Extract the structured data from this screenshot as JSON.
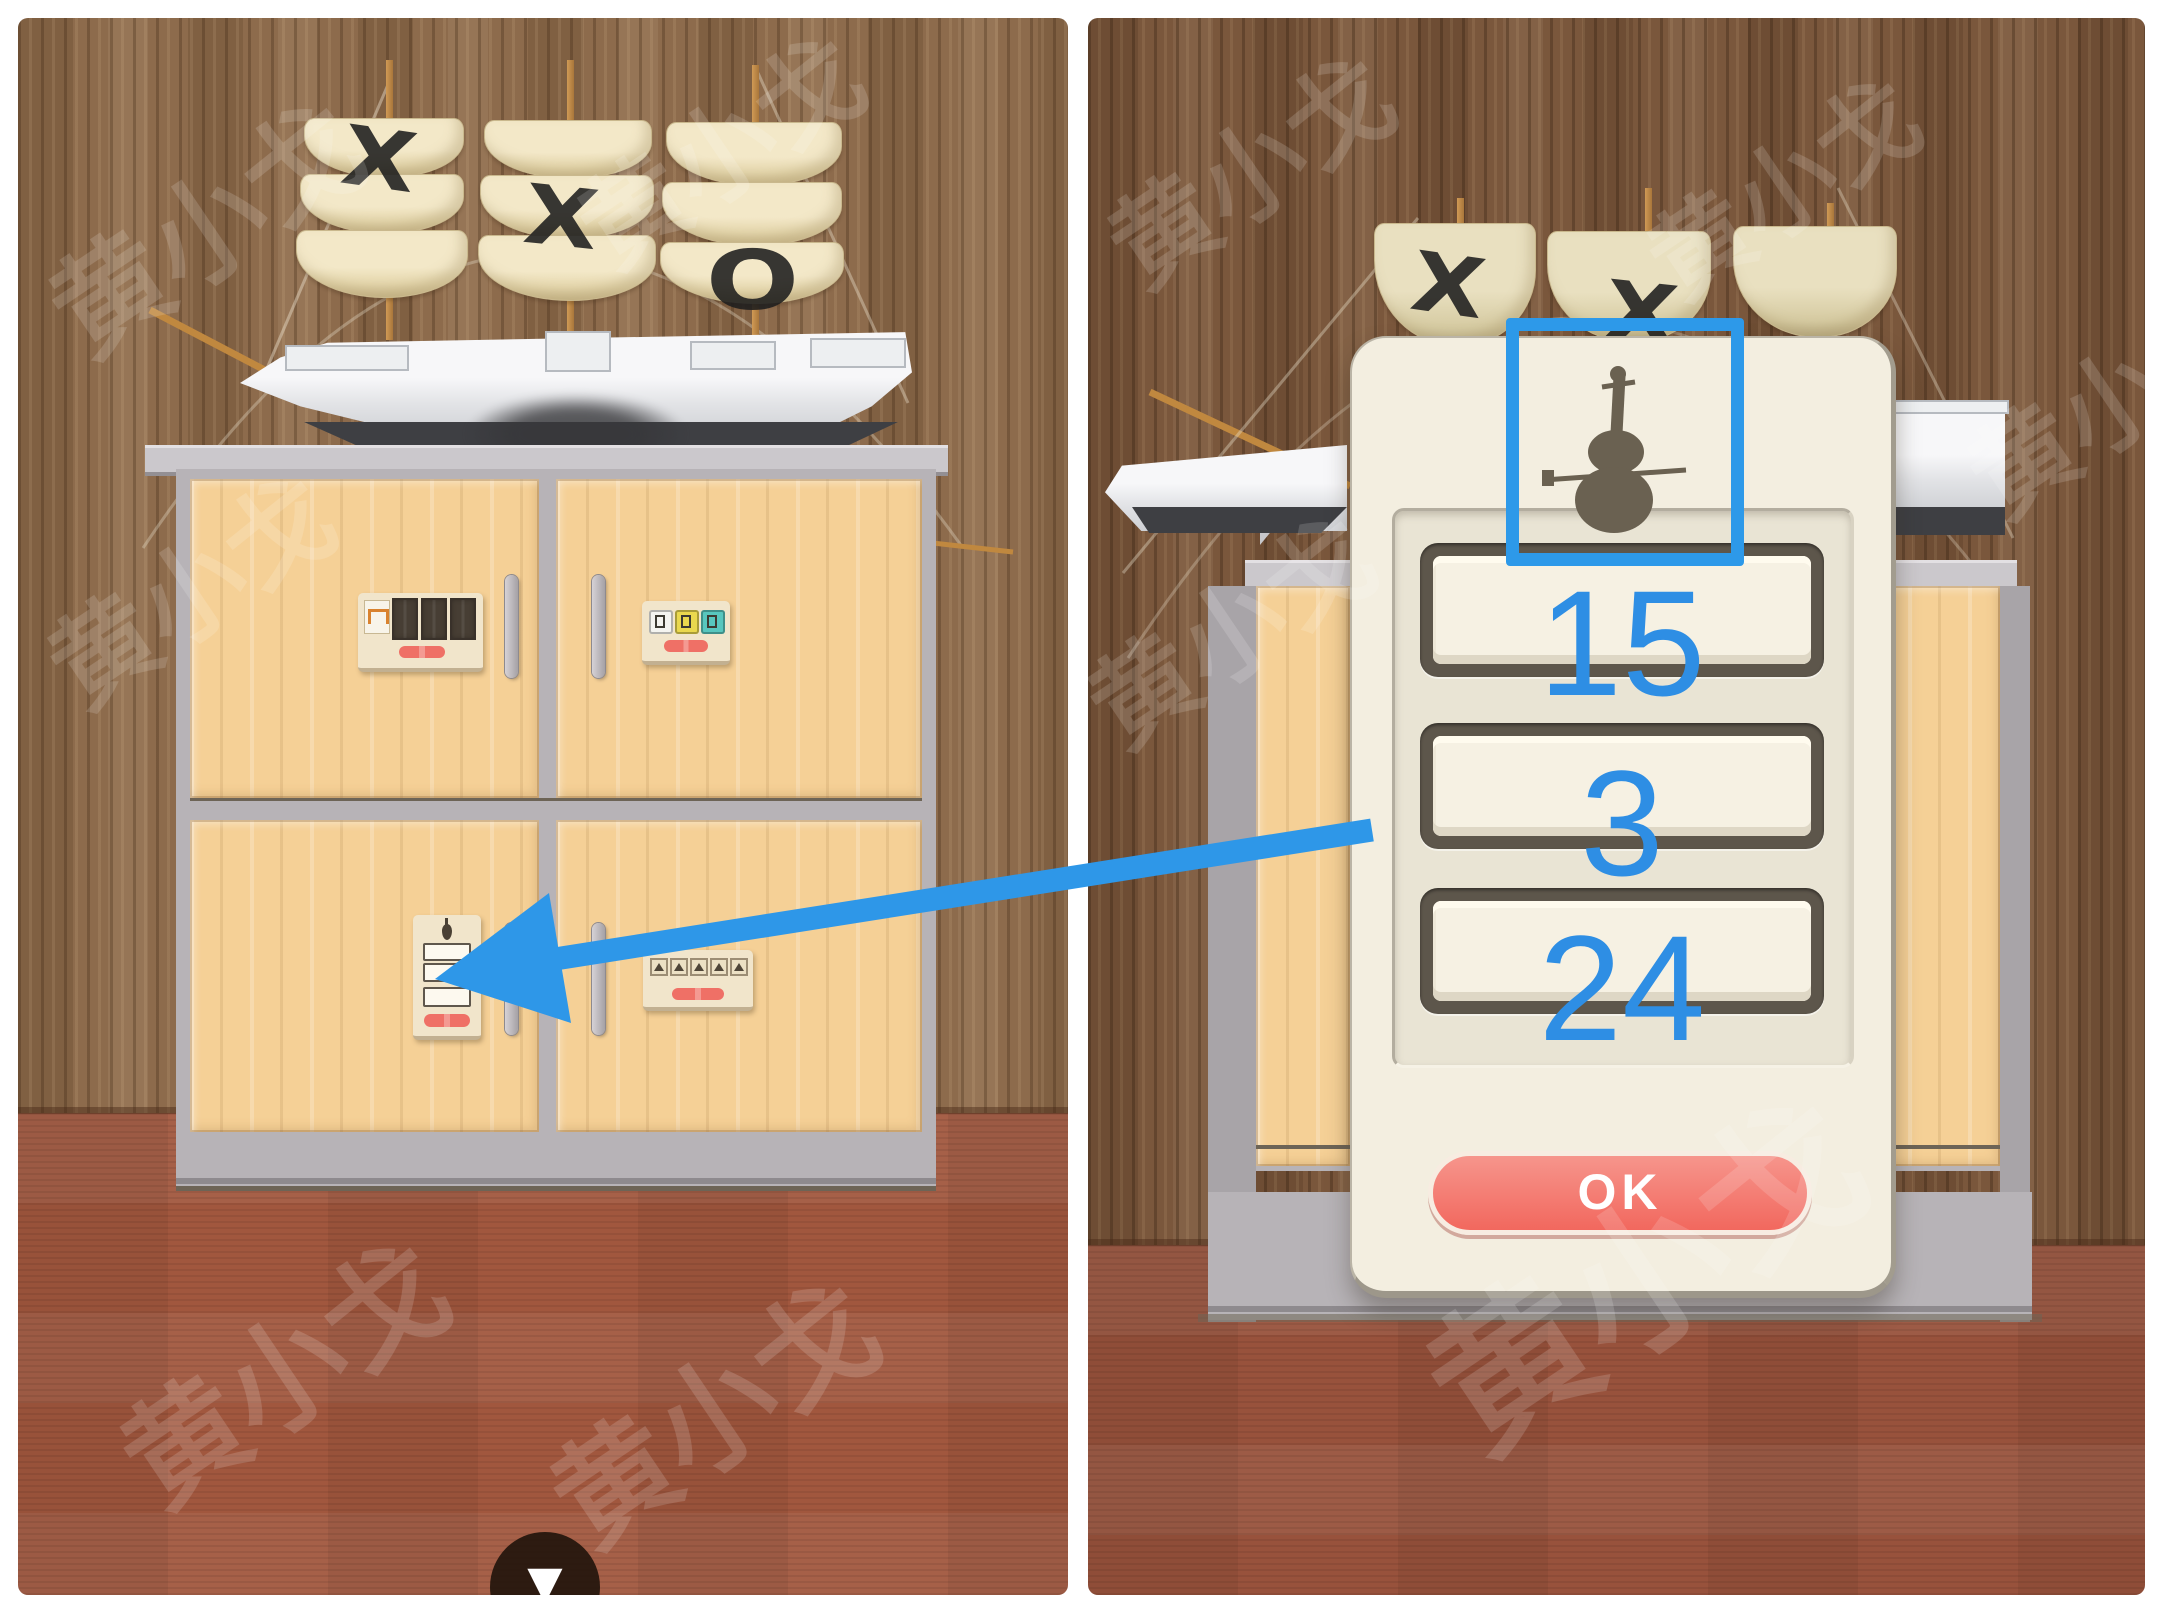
{
  "watermark": {
    "text": "黄小戈"
  },
  "icons": {
    "down_arrow": "▼",
    "violin": "violin-silhouette"
  },
  "left_panel": {
    "ship": {
      "sail_marks": [
        "X",
        "X",
        "O"
      ]
    }
  },
  "right_panel": {
    "ship": {
      "sail_marks": [
        "X",
        "X"
      ]
    },
    "dialog": {
      "icon": "violin",
      "fields": [
        {
          "value": "15"
        },
        {
          "value": "3"
        },
        {
          "value": "24"
        }
      ],
      "ok_label": "OK"
    }
  },
  "annotations": {
    "arrow_color": "#2e97e8",
    "box_color": "#2d99e9",
    "number_color": "#2e8ee4"
  },
  "colors": {
    "ok_button": "#f3695f",
    "red_button": "#ef7066",
    "dialog_bg": "#f3eee0",
    "door_wood": "#f5d096",
    "wall_wood_left": "#8d6b4c",
    "wall_wood_right": "#7a573c",
    "floor_left": "#a1573e",
    "floor_right": "#98523c",
    "sail": "#f3e8c8"
  }
}
